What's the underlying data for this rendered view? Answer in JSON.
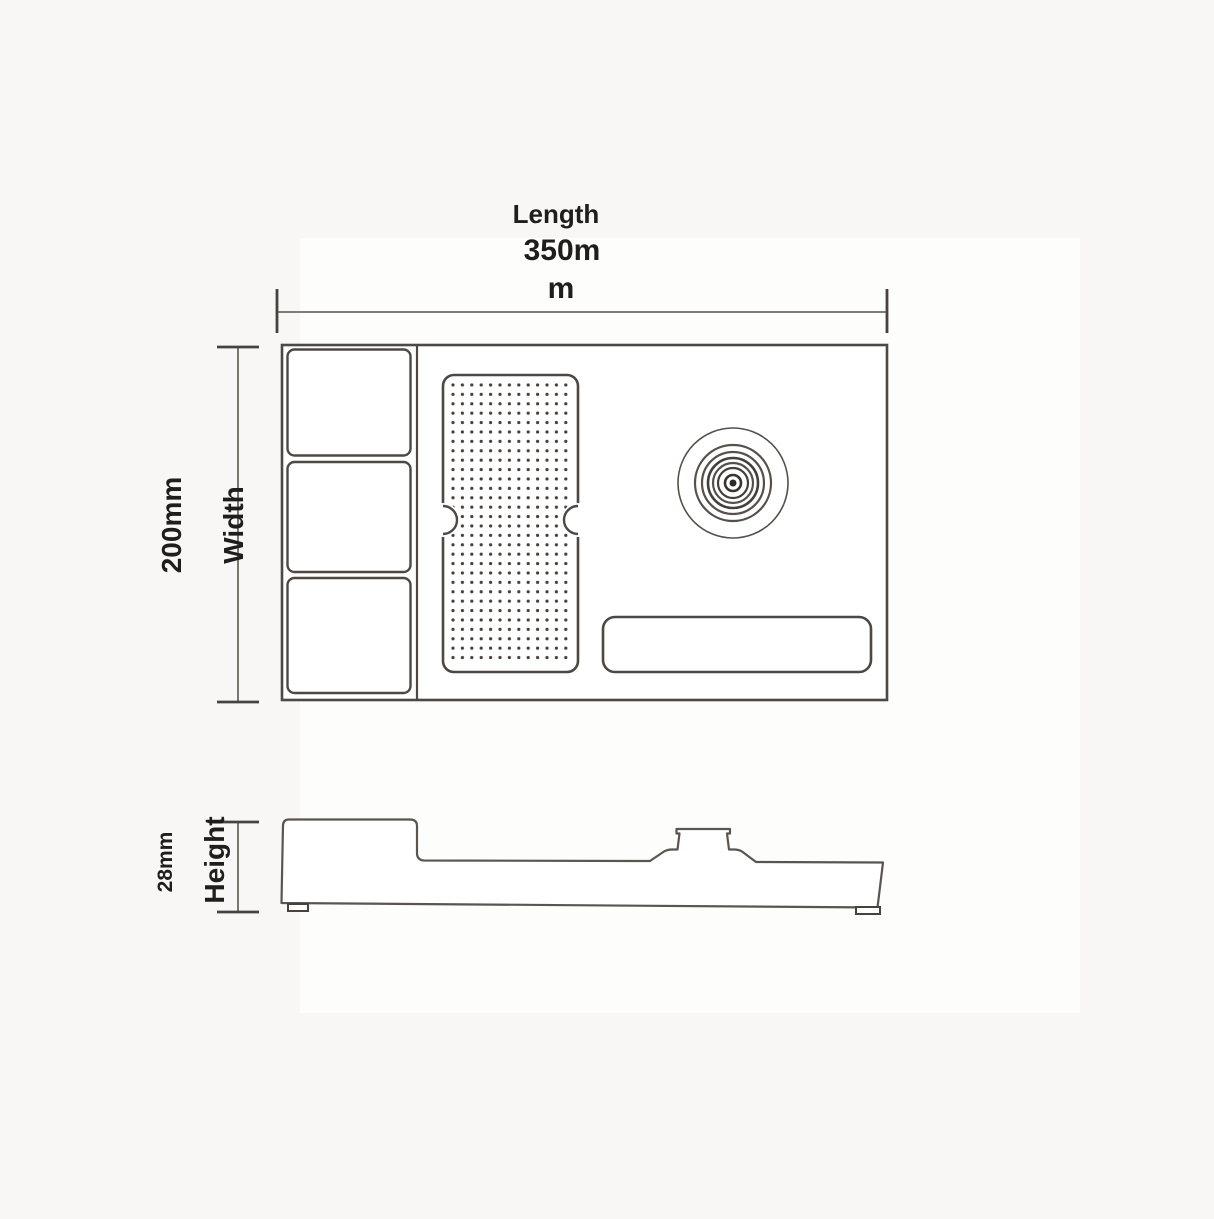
{
  "drawing": {
    "views": {
      "top_view": "product-top-view",
      "side_view": "product-side-profile"
    },
    "dimensions": {
      "length": {
        "label": "Length",
        "value": "350mm",
        "value_lines": [
          "350m",
          "m"
        ]
      },
      "width": {
        "value": "200mm",
        "label": "Width"
      },
      "height": {
        "value": "28mm",
        "label": "Height"
      }
    },
    "colors": {
      "background": "#f8f7f6",
      "paper": "#fdfdfc",
      "line": "#4d4843",
      "thin_line": "#6e6862",
      "text": "#201d1c",
      "dots": "#443f3a"
    }
  }
}
